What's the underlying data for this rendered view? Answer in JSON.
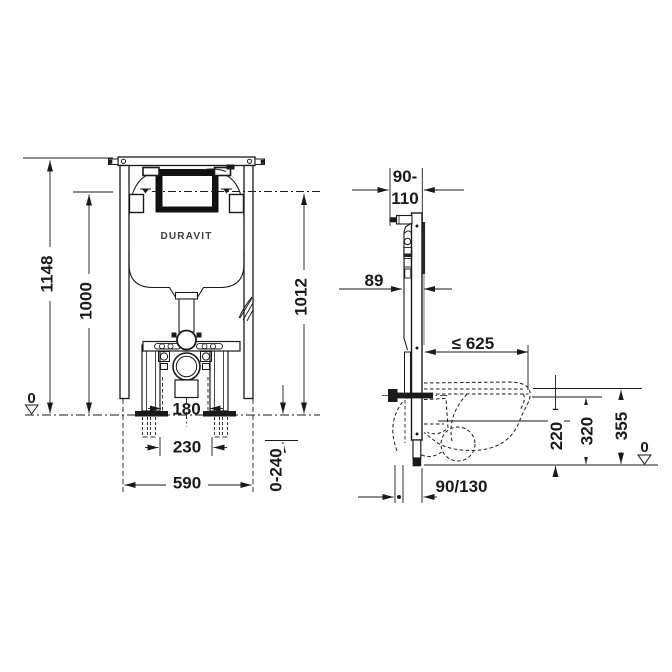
{
  "colors": {
    "background": "#ffffff",
    "line": "#1a1a1a"
  },
  "front_view": {
    "logo": "DURAVIT",
    "dims": {
      "total_height": "1148",
      "actuation_height": "1000",
      "anchor_height": "1012",
      "floor_level": "0",
      "outlet_width": "180",
      "anchor_spacing": "230",
      "frame_width": "590",
      "foot_adjustment": "0-240"
    }
  },
  "side_view": {
    "dims": {
      "wall_distance_line1": "90-",
      "wall_distance_line2": "110",
      "frame_depth": "89",
      "max_depth": "≤ 625",
      "outlet_height": "220",
      "rim_height": "320",
      "top_edge_height": "355",
      "floor_level": "0",
      "outlet_offset": "90/130"
    }
  }
}
